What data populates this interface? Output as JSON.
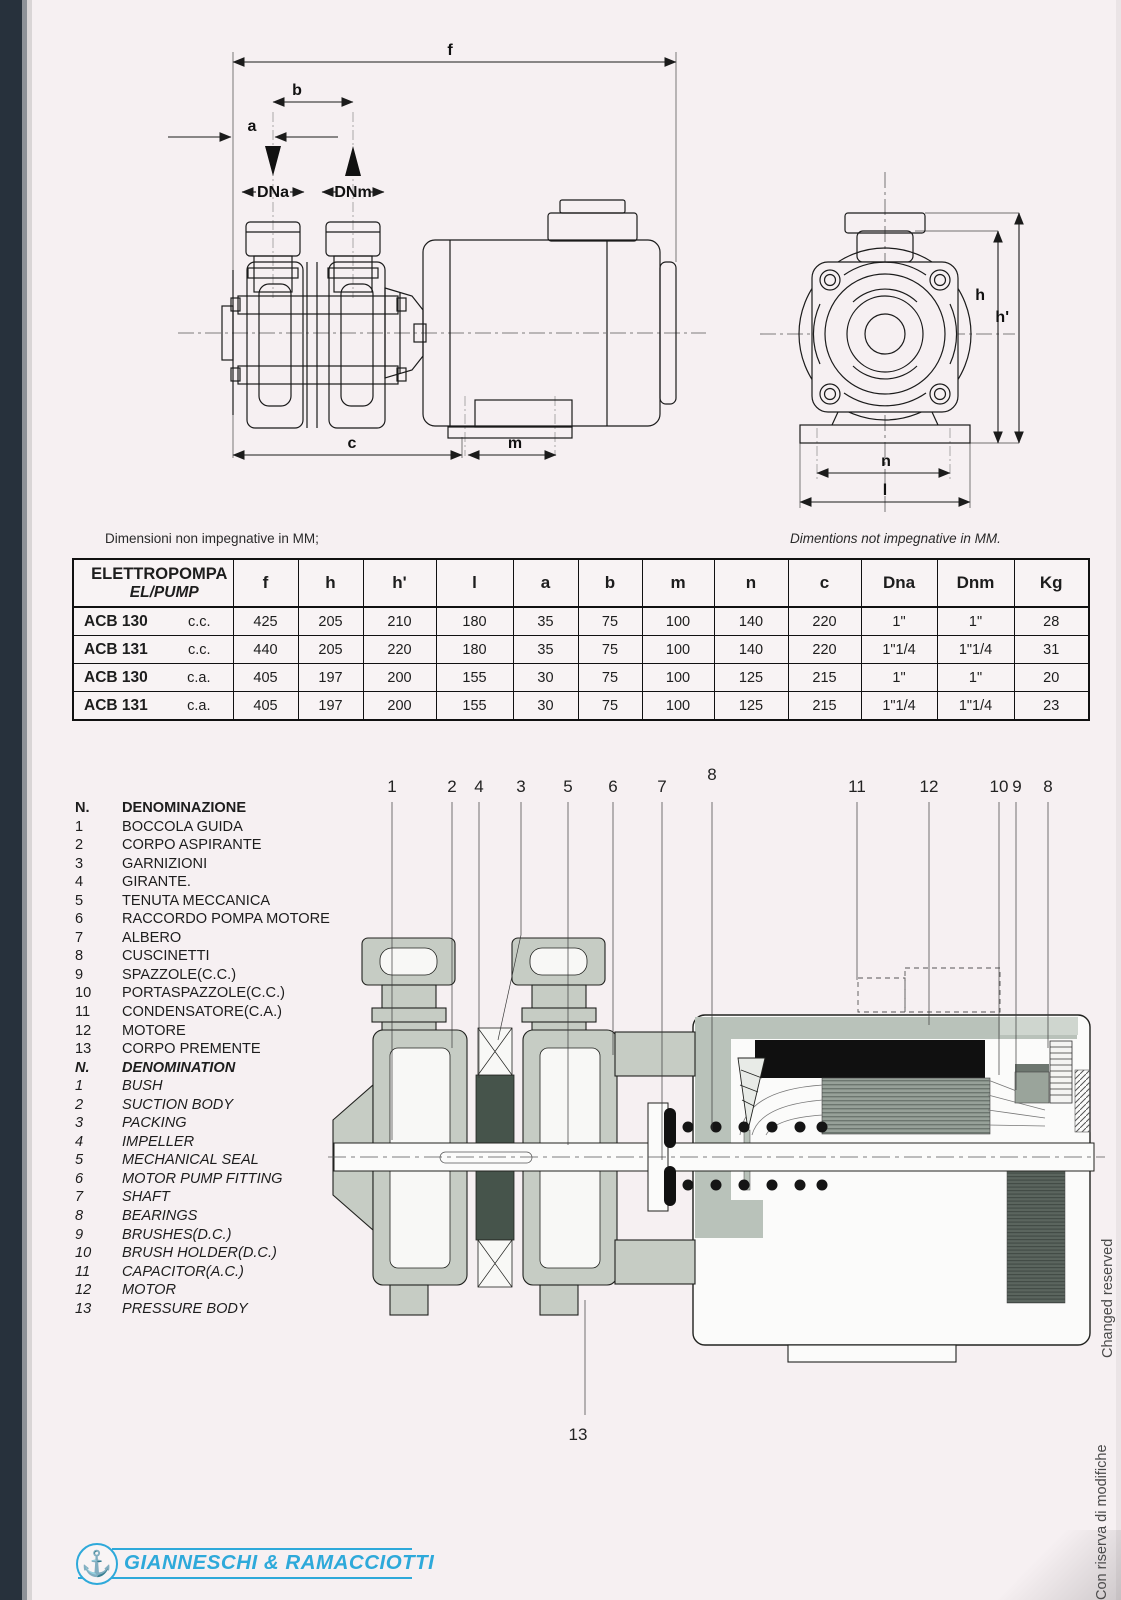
{
  "captions": {
    "left": "Dimensioni non impegnative in MM;",
    "right": "Dimentions not impegnative in MM."
  },
  "dims": {
    "f": "f",
    "b": "b",
    "a": "a",
    "dna": "DNa",
    "dnm": "DNm",
    "c": "c",
    "m": "m",
    "h": "h",
    "h_prime": "h'",
    "n": "n",
    "l": "l"
  },
  "table": {
    "header": {
      "col1_line1": "ELETTROPOMPA",
      "col1_line2": "EL/PUMP",
      "cols": [
        "f",
        "h",
        "h'",
        "l",
        "a",
        "b",
        "m",
        "n",
        "c",
        "Dna",
        "Dnm",
        "Kg"
      ]
    },
    "rows": [
      {
        "model": "ACB 130",
        "variant": "c.c.",
        "values": [
          "425",
          "205",
          "210",
          "180",
          "35",
          "75",
          "100",
          "140",
          "220",
          "1\"",
          "1\"",
          "28"
        ]
      },
      {
        "model": "ACB 131",
        "variant": "c.c.",
        "values": [
          "440",
          "205",
          "220",
          "180",
          "35",
          "75",
          "100",
          "140",
          "220",
          "1\"1/4",
          "1\"1/4",
          "31"
        ]
      },
      {
        "model": "ACB 130",
        "variant": "c.a.",
        "values": [
          "405",
          "197",
          "200",
          "155",
          "30",
          "75",
          "100",
          "125",
          "215",
          "1\"",
          "1\"",
          "20"
        ]
      },
      {
        "model": "ACB 131",
        "variant": "c.a.",
        "values": [
          "405",
          "197",
          "200",
          "155",
          "30",
          "75",
          "100",
          "125",
          "215",
          "1\"1/4",
          "1\"1/4",
          "23"
        ]
      }
    ]
  },
  "parts": {
    "header_it": {
      "n": "N.",
      "name": "DENOMINAZIONE"
    },
    "items_it": [
      {
        "n": "1",
        "name": "BOCCOLA GUIDA"
      },
      {
        "n": "2",
        "name": "CORPO ASPIRANTE"
      },
      {
        "n": "3",
        "name": "GARNIZIONI"
      },
      {
        "n": "4",
        "name": "GIRANTE."
      },
      {
        "n": "5",
        "name": "TENUTA MECCANICA"
      },
      {
        "n": "6",
        "name": "RACCORDO POMPA MOTORE"
      },
      {
        "n": "7",
        "name": "ALBERO"
      },
      {
        "n": "8",
        "name": "CUSCINETTI"
      },
      {
        "n": "9",
        "name": "SPAZZOLE(C.C.)"
      },
      {
        "n": "10",
        "name": "PORTASPAZZOLE(C.C.)"
      },
      {
        "n": "11",
        "name": "CONDENSATORE(C.A.)"
      },
      {
        "n": "12",
        "name": "MOTORE"
      },
      {
        "n": "13",
        "name": "CORPO PREMENTE"
      }
    ],
    "header_en": {
      "n": "N.",
      "name": "DENOMINATION"
    },
    "items_en": [
      {
        "n": "1",
        "name": "BUSH"
      },
      {
        "n": "2",
        "name": "SUCTION BODY"
      },
      {
        "n": "3",
        "name": "PACKING"
      },
      {
        "n": "4",
        "name": "IMPELLER"
      },
      {
        "n": "5",
        "name": "MECHANICAL SEAL"
      },
      {
        "n": "6",
        "name": "MOTOR PUMP FITTING"
      },
      {
        "n": "7",
        "name": "SHAFT"
      },
      {
        "n": "8",
        "name": "BEARINGS"
      },
      {
        "n": "9",
        "name": "BRUSHES(D.C.)"
      },
      {
        "n": "10",
        "name": "BRUSH HOLDER(D.C.)"
      },
      {
        "n": "11",
        "name": "CAPACITOR(A.C.)"
      },
      {
        "n": "12",
        "name": "MOTOR"
      },
      {
        "n": "13",
        "name": "PRESSURE BODY"
      }
    ]
  },
  "callouts": {
    "top": [
      "1",
      "2",
      "4",
      "3",
      "5",
      "6",
      "7",
      "8",
      "11",
      "12",
      "10",
      "9",
      "8"
    ],
    "bottom": "13"
  },
  "footer": {
    "brand": "GIANNESCHI & RAMACCIOTTI",
    "logo_color": "#2ea9da",
    "anchor_icon": "⚓"
  },
  "notes": {
    "it": "Con riserva di modifiche",
    "en": "Changed reserved"
  }
}
